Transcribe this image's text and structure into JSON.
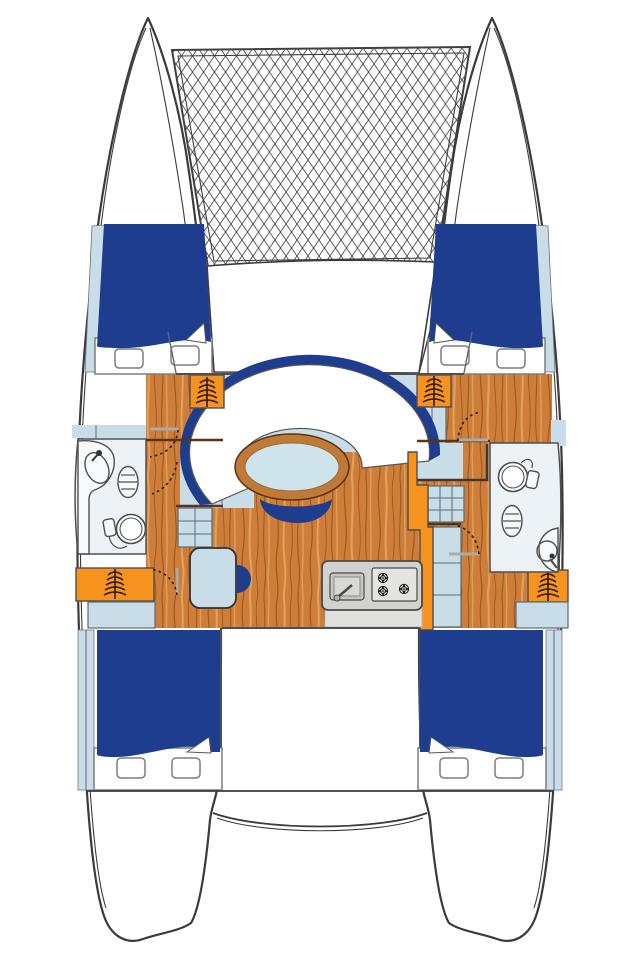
{
  "title": "Catamaran interior deck plan",
  "colors": {
    "outline": "#3b3b3b",
    "fixture": "#4f4f4f",
    "bed_blue": "#1e3d8f",
    "light_blue": "#c9dde9",
    "pale_room": "#ecf2f6",
    "wood": "#cd7e3a",
    "wood_dark": "#a2591c",
    "wood_light": "#e8ab62",
    "wood_edge": "#5a3416",
    "table_rim": "#c07a38",
    "table_top": "#cfe3ed",
    "orange": "#f6921e",
    "counter": "#d2d2d0",
    "counter_light": "#e0e0de",
    "stove": "#e4e4e2",
    "burner": "#1c1c1c",
    "mesh_line": "#4a4a4a",
    "door_arc": "#2e2005",
    "door_leaf": "#ababab",
    "steps": "#241503"
  },
  "parts": [
    "trampoline-net",
    "port-hull",
    "starboard-hull",
    "foredeck",
    "saloon-floor",
    "saloon-sofa",
    "saloon-table",
    "saloon-bench",
    "chart-table",
    "chart-table-stool",
    "galley-counter",
    "galley-sink",
    "galley-stove",
    "port-head",
    "port-head-sink",
    "port-head-toilet",
    "starboard-head",
    "starboard-head-sink",
    "starboard-head-toilet",
    "port-forward-berth",
    "starboard-forward-berth",
    "port-aft-berth",
    "starboard-aft-berth",
    "companionway-steps",
    "storage-lockers",
    "aft-deck"
  ]
}
